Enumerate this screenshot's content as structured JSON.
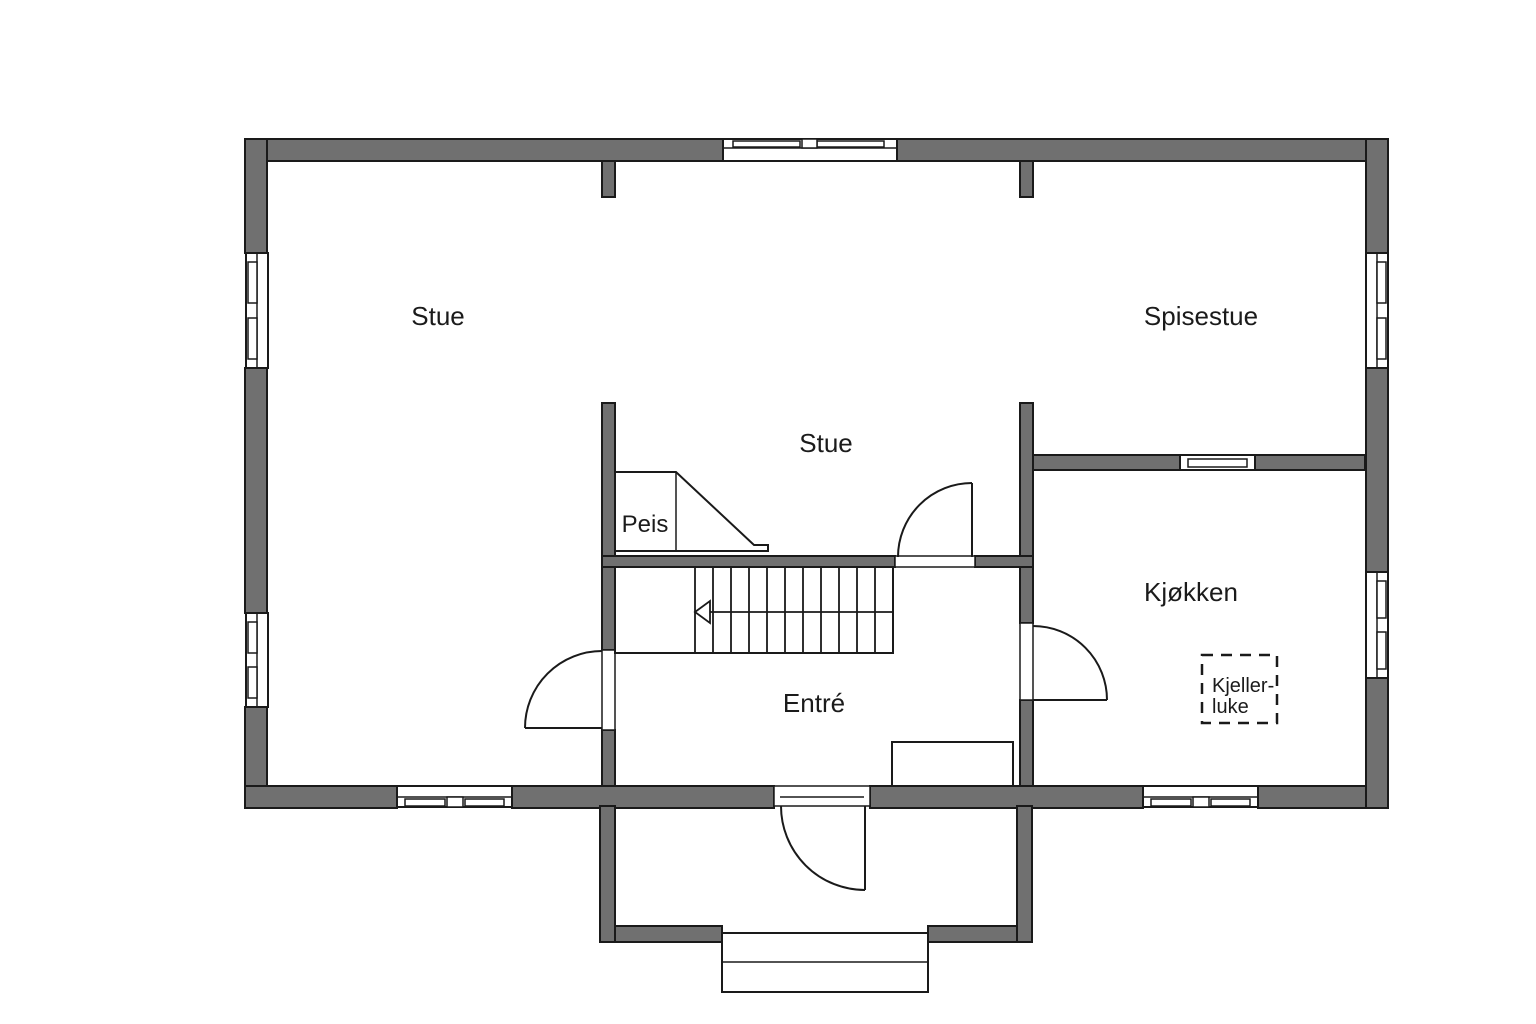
{
  "plan": {
    "colors": {
      "wall": "#707070",
      "lines": "#1a1a1a",
      "background": "#ffffff"
    },
    "rooms": [
      {
        "id": "stue-left",
        "label": "Stue"
      },
      {
        "id": "spisestue",
        "label": "Spisestue"
      },
      {
        "id": "stue-middle",
        "label": "Stue"
      },
      {
        "id": "kjokken",
        "label": "Kjøkken"
      },
      {
        "id": "entre",
        "label": "Entré"
      }
    ],
    "fireplace": {
      "label": "Peis"
    },
    "cellar_hatch": {
      "label_line1": "Kjeller-",
      "label_line2": "luke"
    }
  }
}
